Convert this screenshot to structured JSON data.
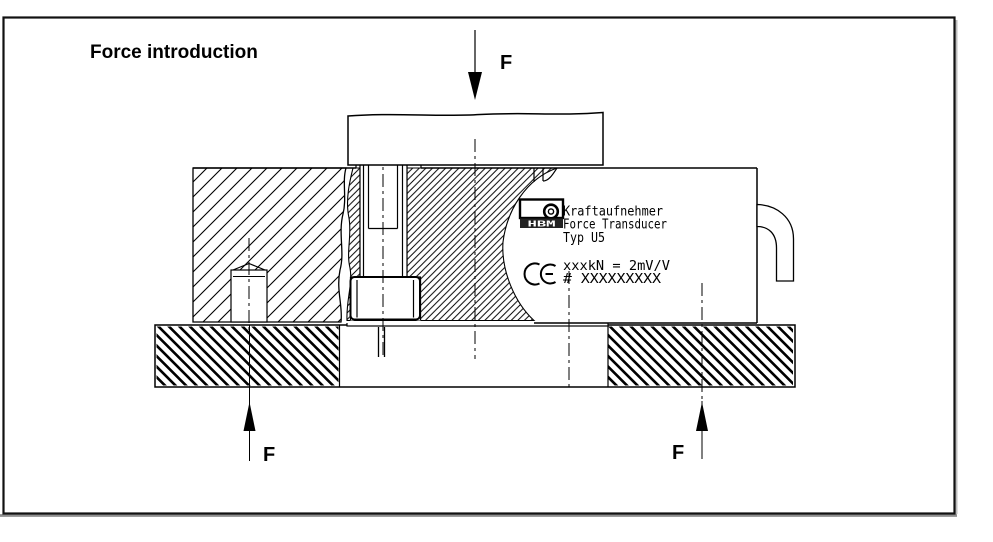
{
  "figure": {
    "title": "Force introduction"
  },
  "force_arrows": {
    "top": "F",
    "bottom_left": "F",
    "bottom_right": "F"
  },
  "transducer_label": {
    "brand": "HBM",
    "name_de": "Kraftaufnehmer",
    "name_en": "Force Transducer",
    "type": "Typ U5",
    "rating": "xxxkN = 2mV/V",
    "serial": "# XXXXXXXXX",
    "ce_mark": "CE"
  },
  "colors": {
    "line": "#000000",
    "background": "#ffffff",
    "frame_border": "#111111",
    "frame_shadow": "#8f8f8f",
    "logo_band": "#222222"
  }
}
